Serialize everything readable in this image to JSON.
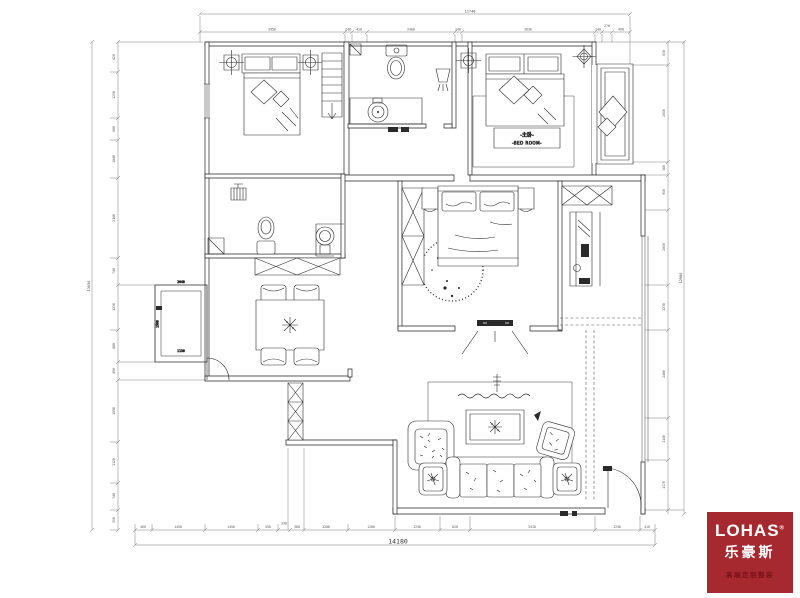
{
  "labels": {
    "master_cn": "-主卧-",
    "master_en": "-BED ROOM-"
  },
  "dims": {
    "top_total": "11740",
    "top_segs": [
      "3950",
      "240",
      "410",
      "2400",
      "240",
      "3630",
      "240",
      "270",
      "490"
    ],
    "bottom_total": "14180",
    "bottom_segs": [
      "460",
      "1450",
      "1450",
      "550",
      "330",
      "380",
      "1200",
      "1280",
      "1230",
      "820",
      "3410",
      "1230",
      "410"
    ],
    "left_total": "13050",
    "left_segs": [
      "820",
      "1250",
      "600",
      "1040",
      "2180",
      "740",
      "1230",
      "880",
      "490",
      "1690",
      "1120",
      "740",
      "550"
    ],
    "right_total": "12980",
    "right_segs": [
      "630",
      "2650",
      "360",
      "950",
      "2050",
      "1230",
      "2400",
      "1140",
      "1370"
    ],
    "balcony": [
      "2040",
      "1500",
      "1130"
    ]
  },
  "logo": {
    "brand": "LOHAS",
    "reg": "®",
    "brand_cn": "乐豪斯",
    "tagline": "高端定制整装",
    "bg_color": "#A6292F"
  }
}
